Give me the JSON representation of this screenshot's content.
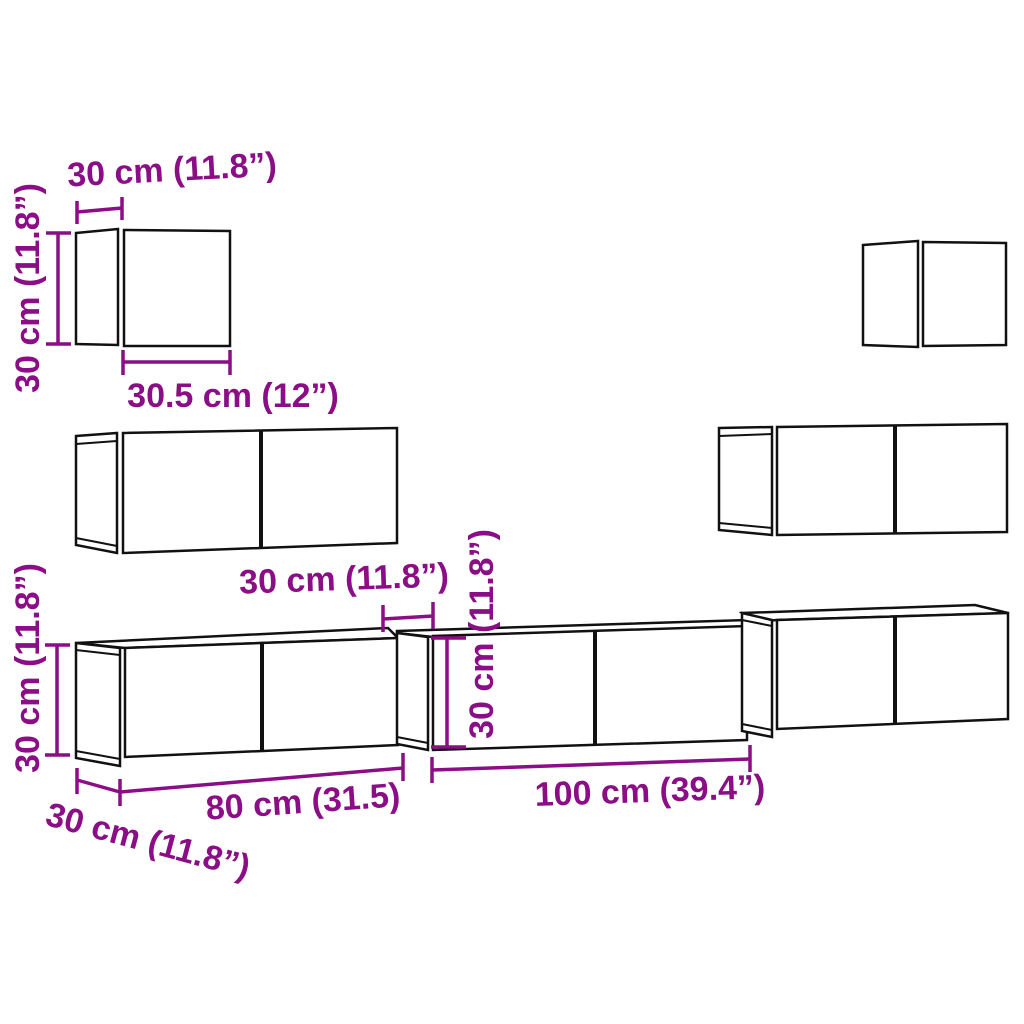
{
  "meta": {
    "title": "Wall-mounted TV cabinet set — dimension diagram",
    "units": "cm / inches"
  },
  "colors": {
    "dimension": "#8B0E86",
    "outline": "#111111",
    "background": "#FFFFFF"
  },
  "dimensions": {
    "small_cabinet": {
      "depth": "30 cm (11.8”)",
      "height": "30 cm (11.8”)",
      "width": "30.5 cm (12”)"
    },
    "medium_cabinet": {
      "height": "30 cm (11.8”)",
      "width": "80 cm (31.5)",
      "depth": "30 cm (11.8”)"
    },
    "large_cabinet": {
      "depth": "30 cm (11.8”)",
      "height": "30 cm (11.8”)",
      "width": "100 cm (39.4”)"
    }
  }
}
